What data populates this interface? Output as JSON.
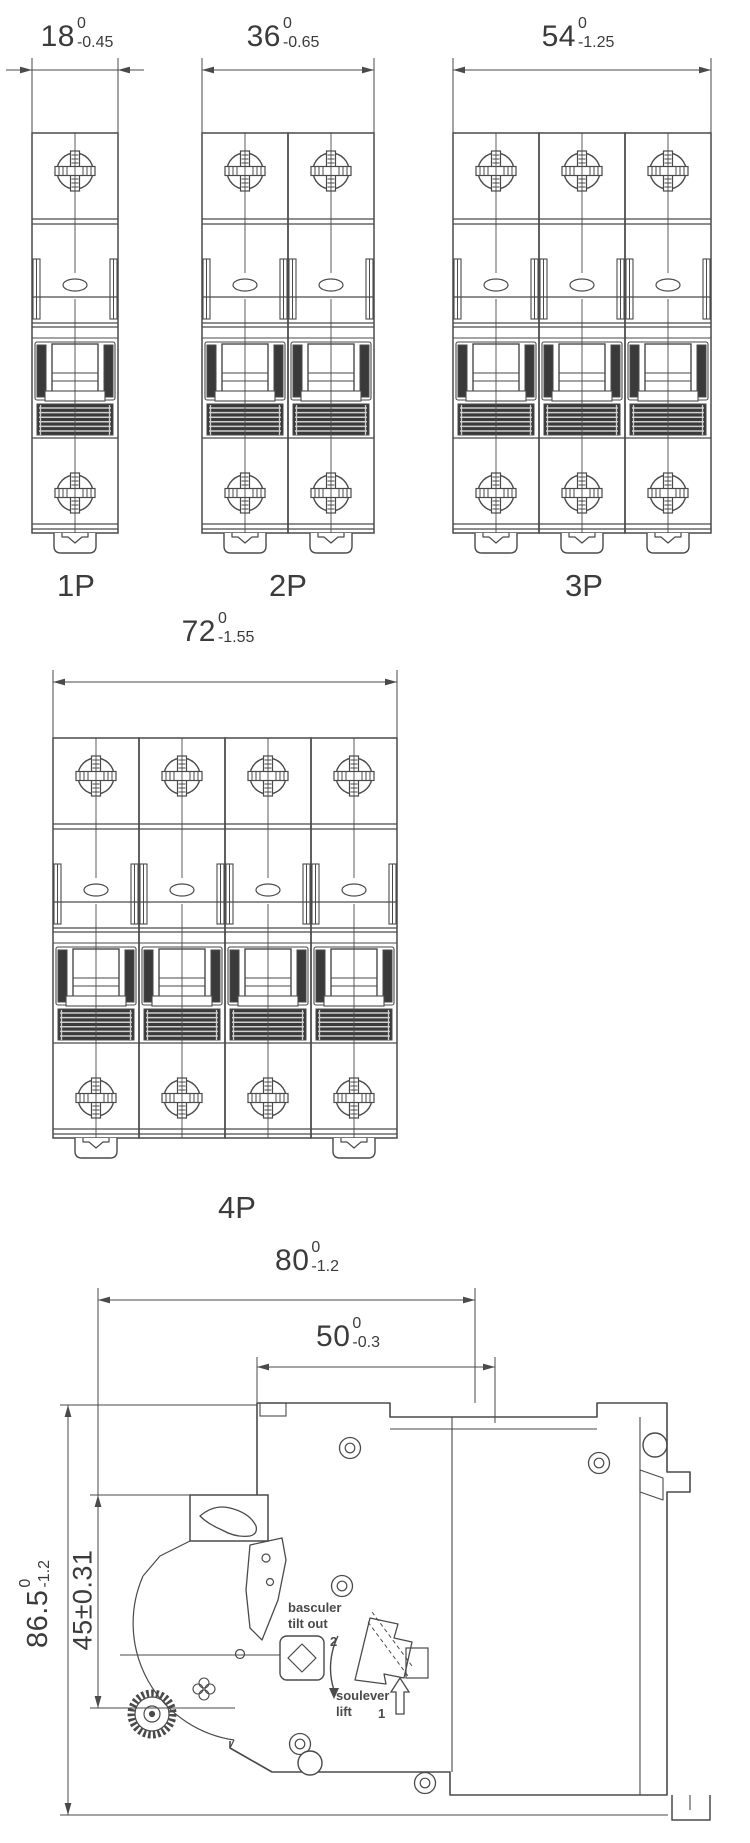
{
  "drawing": {
    "background": "#ffffff",
    "line_color": "#4a4a4a",
    "dark_fill": "#3a3a3a",
    "text_color": "#3b3b3b",
    "views": [
      {
        "id": "1p",
        "label": "1P",
        "poles": 1,
        "dim": {
          "value": "18",
          "sup": "0",
          "sub": "-0.45"
        }
      },
      {
        "id": "2p",
        "label": "2P",
        "poles": 2,
        "dim": {
          "value": "36",
          "sup": "0",
          "sub": "-0.65"
        }
      },
      {
        "id": "3p",
        "label": "3P",
        "poles": 3,
        "dim": {
          "value": "54",
          "sup": "0",
          "sub": "-1.25"
        }
      },
      {
        "id": "4p",
        "label": "4P",
        "poles": 4,
        "dim": {
          "value": "72",
          "sup": "0",
          "sub": "-1.55"
        }
      }
    ],
    "side_view": {
      "dims": {
        "depth_total": {
          "value": "80",
          "sup": "0",
          "sub": "-1.2"
        },
        "depth_front": {
          "value": "50",
          "sup": "0",
          "sub": "-0.3"
        },
        "height_total": {
          "value": "86.5",
          "sup": "0",
          "sub": "-1.2"
        },
        "handle_height": {
          "value": "45±0.31"
        }
      },
      "annotations": {
        "tilt_out_fr": "basculer",
        "tilt_out_en": "tilt out",
        "step_tilt": "2",
        "lift_fr": "soulever",
        "lift_en": "lift",
        "step_lift": "1"
      }
    }
  }
}
